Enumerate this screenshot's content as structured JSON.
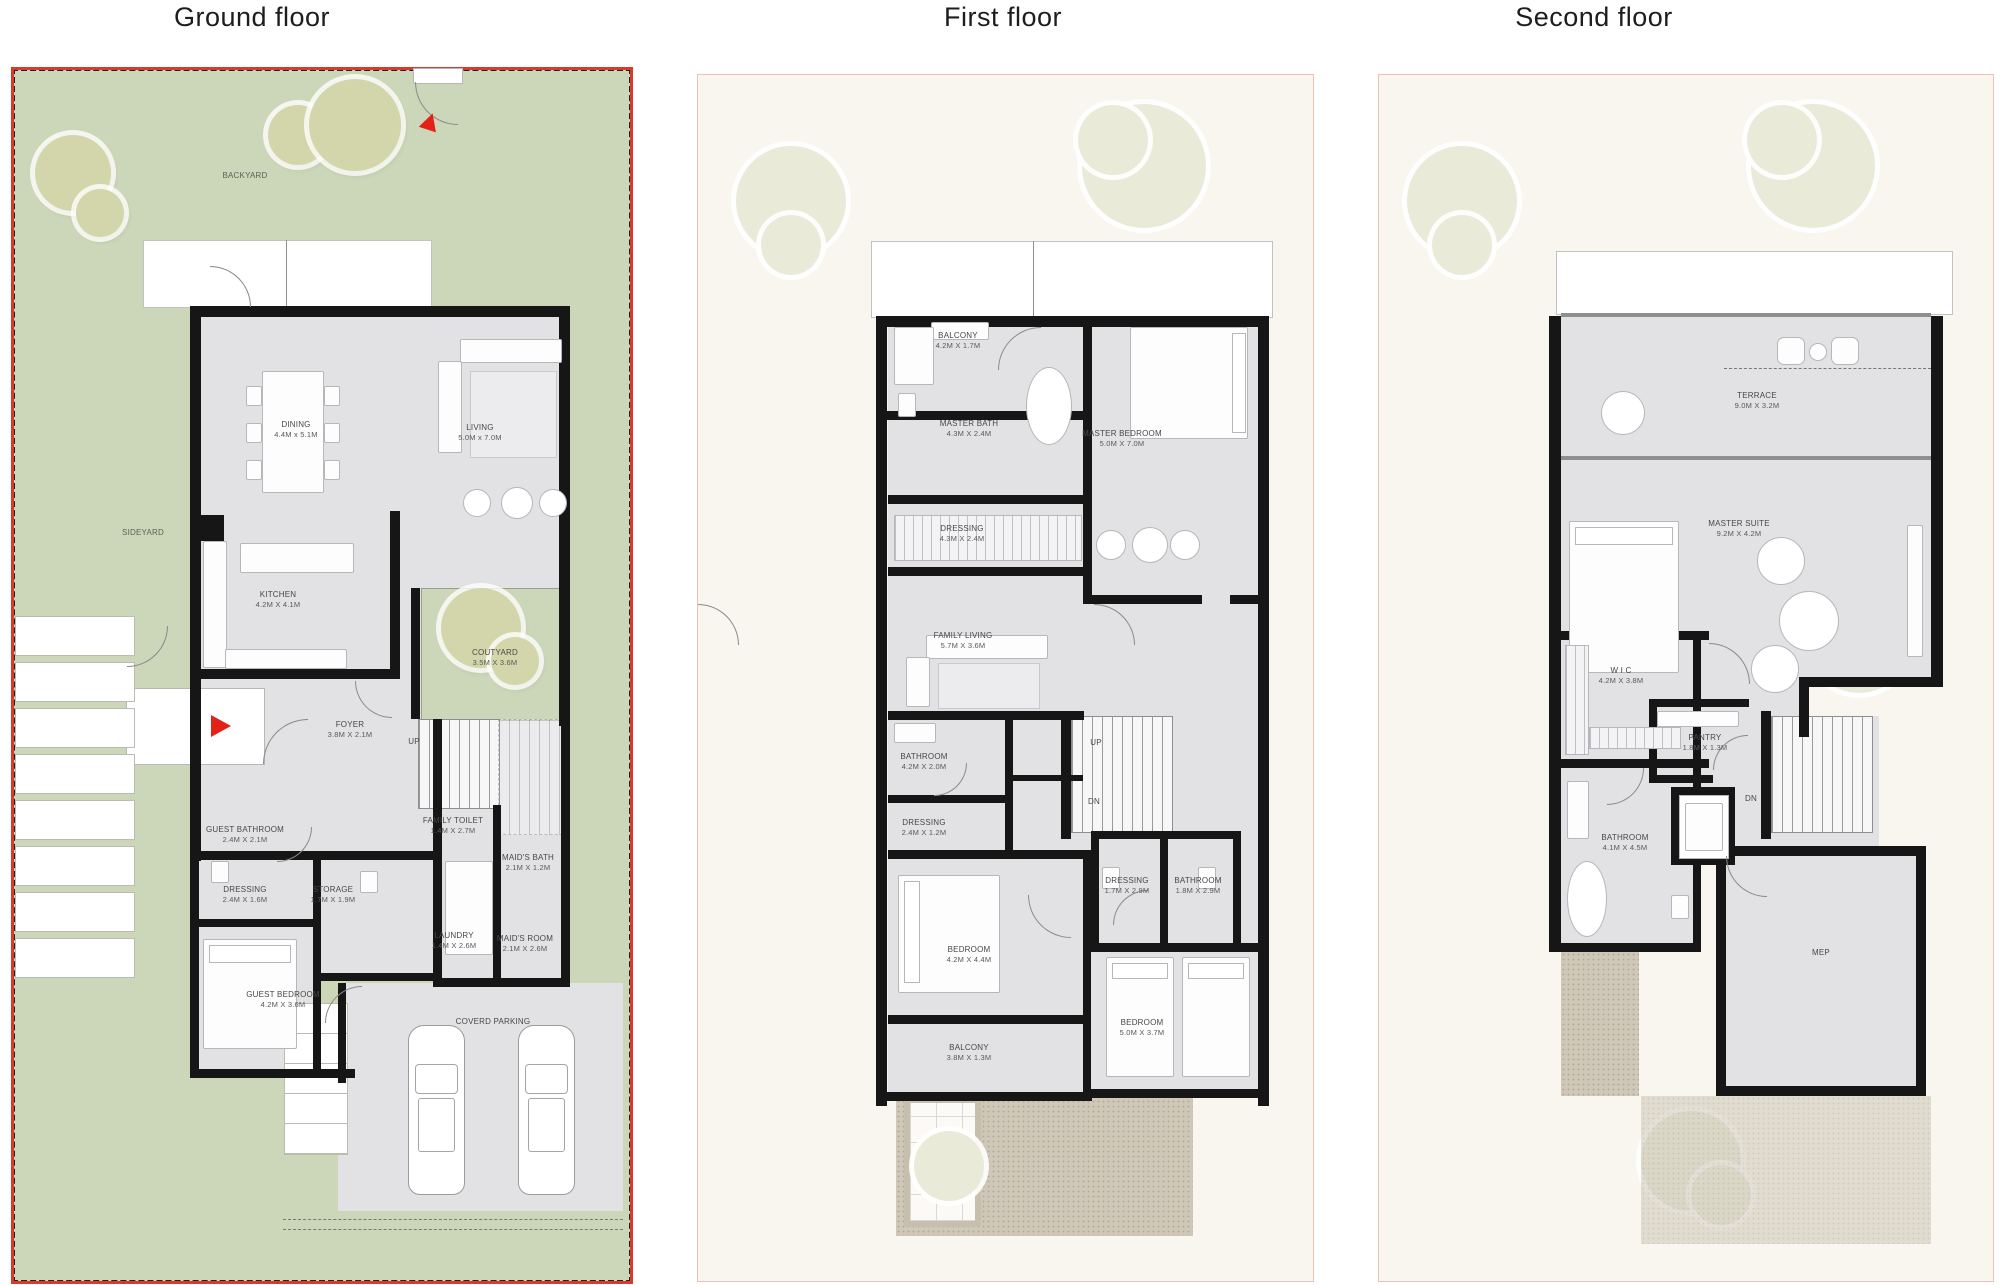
{
  "colors": {
    "yard": "#ccd6b8",
    "tree": "#d3d6aa",
    "treefaded": "#e9ebd8",
    "plan": "#e2e2e5",
    "wall": "#161616",
    "red": "#d93a2b",
    "pink": "#f0bfb6",
    "cream": "#f8f6ef",
    "paving": "#cfc8b8",
    "arrow": "#e32119"
  },
  "floors": [
    {
      "title": "Ground floor",
      "rooms": [
        {
          "label": "BACKYARD"
        },
        {
          "label": "SIDEYARD"
        },
        {
          "label": "DINING",
          "dims": "4.4M x 5.1M"
        },
        {
          "label": "LIVING",
          "dims": "5.0M x 7.0M"
        },
        {
          "label": "KITCHEN",
          "dims": "4.2M X 4.1M"
        },
        {
          "label": "COUTYARD",
          "dims": "3.5M X 3.6M"
        },
        {
          "label": "FOYER",
          "dims": "3.8M X 2.1M"
        },
        {
          "label": "UP"
        },
        {
          "label": "GUEST BATHROOM",
          "dims": "2.4M X 2.1M"
        },
        {
          "label": "FAMILY TOILET",
          "dims": "1.4M X 2.7M"
        },
        {
          "label": "MAID'S BATH",
          "dims": "2.1M X 1.2M"
        },
        {
          "label": "DRESSING",
          "dims": "2.4M X 1.6M"
        },
        {
          "label": "STORAGE",
          "dims": "1.7M X 1.9M"
        },
        {
          "label": "LAUNDRY",
          "dims": "1.4M X 2.6M"
        },
        {
          "label": "MAID'S ROOM",
          "dims": "2.1M X 2.6M"
        },
        {
          "label": "GUEST BEDROOM",
          "dims": "4.2M X 3.6M"
        },
        {
          "label": "COVERD PARKING"
        }
      ]
    },
    {
      "title": "First floor",
      "rooms": [
        {
          "label": "BALCONY",
          "dims": "4.2M X 1.7M"
        },
        {
          "label": "MASTER BATH",
          "dims": "4.3M X 2.4M"
        },
        {
          "label": "MASTER BEDROOM",
          "dims": "5.0M X 7.0M"
        },
        {
          "label": "DRESSING",
          "dims": "4.3M X 2.4M"
        },
        {
          "label": "FAMILY LIVING",
          "dims": "5.7M X 3.6M"
        },
        {
          "label": "BATHROOM",
          "dims": "4.2M X 2.0M"
        },
        {
          "label": "DRESSING",
          "dims": "2.4M X 1.2M"
        },
        {
          "label": "UP"
        },
        {
          "label": "DN"
        },
        {
          "label": "DRESSING",
          "dims": "1.7M X 2.9M"
        },
        {
          "label": "BATHROOM",
          "dims": "1.8M X 2.9M"
        },
        {
          "label": "BEDROOM",
          "dims": "4.2M X 4.4M"
        },
        {
          "label": "BEDROOM",
          "dims": "5.0M X 3.7M"
        },
        {
          "label": "BALCONY",
          "dims": "3.8M X 1.3M"
        }
      ]
    },
    {
      "title": "Second floor",
      "rooms": [
        {
          "label": "TERRACE",
          "dims": "9.0M X 3.2M"
        },
        {
          "label": "MASTER SUITE",
          "dims": "9.2M X 4.2M"
        },
        {
          "label": "W I C",
          "dims": "4.2M X 3.8M"
        },
        {
          "label": "PANTRY",
          "dims": "1.8M X 1.3M"
        },
        {
          "label": "DN"
        },
        {
          "label": "BATHROOM",
          "dims": "4.1M X 4.5M"
        },
        {
          "label": "MEP"
        }
      ]
    }
  ]
}
